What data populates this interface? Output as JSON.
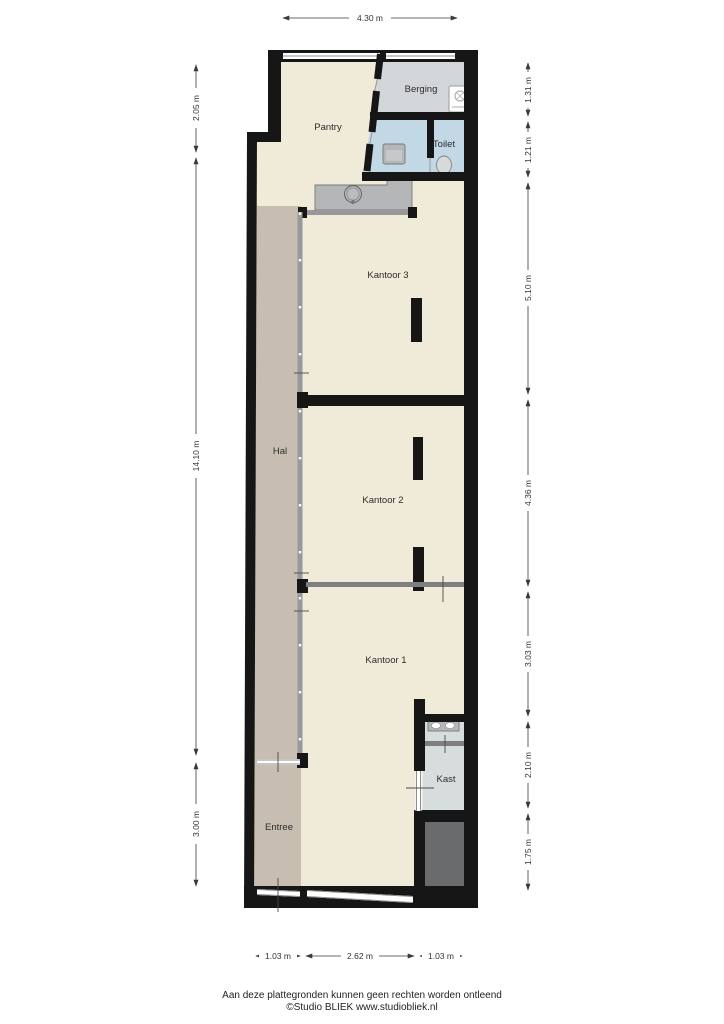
{
  "plan": {
    "rooms": {
      "pantry": {
        "label": "Pantry"
      },
      "berging": {
        "label": "Berging"
      },
      "toilet": {
        "label": "Toilet"
      },
      "kantoor3": {
        "label": "Kantoor 3"
      },
      "hal": {
        "label": "Hal"
      },
      "kantoor2": {
        "label": "Kantoor 2"
      },
      "kantoor1": {
        "label": "Kantoor 1"
      },
      "kast": {
        "label": "Kast"
      },
      "entree": {
        "label": "Entree"
      }
    },
    "dims": {
      "top": [
        "4.30 m"
      ],
      "left": [
        "2.05 m",
        "14.10 m",
        "3.00 m"
      ],
      "right": [
        "1.31 m",
        "1.21 m",
        "5.10 m",
        "4.36 m",
        "3.03 m",
        "2.10 m",
        "1.75 m"
      ],
      "bottom": [
        "1.03 m",
        "2.62 m",
        "1.03 m"
      ]
    },
    "icons": [
      "washing-machine-icon",
      "bathroom-sink-icon",
      "toilet-bowl-icon",
      "kitchen-sink-icon",
      "double-basin-icon"
    ],
    "colors": {
      "floor_cream": "#f0ead8",
      "floor_taupe": "#c7beb1",
      "floor_gray": "#d3d6d9",
      "floor_blue": "#c3d8e5",
      "floor_kast": "#d7dddd",
      "void_dark": "#6a6b6c",
      "wall_black": "#161616",
      "glass_gray": "#98989b"
    }
  },
  "footer": {
    "line1": "Aan deze plattegronden kunnen geen rechten worden ontleend",
    "line2": "©Studio BLIEK www.studiobliek.nl"
  }
}
